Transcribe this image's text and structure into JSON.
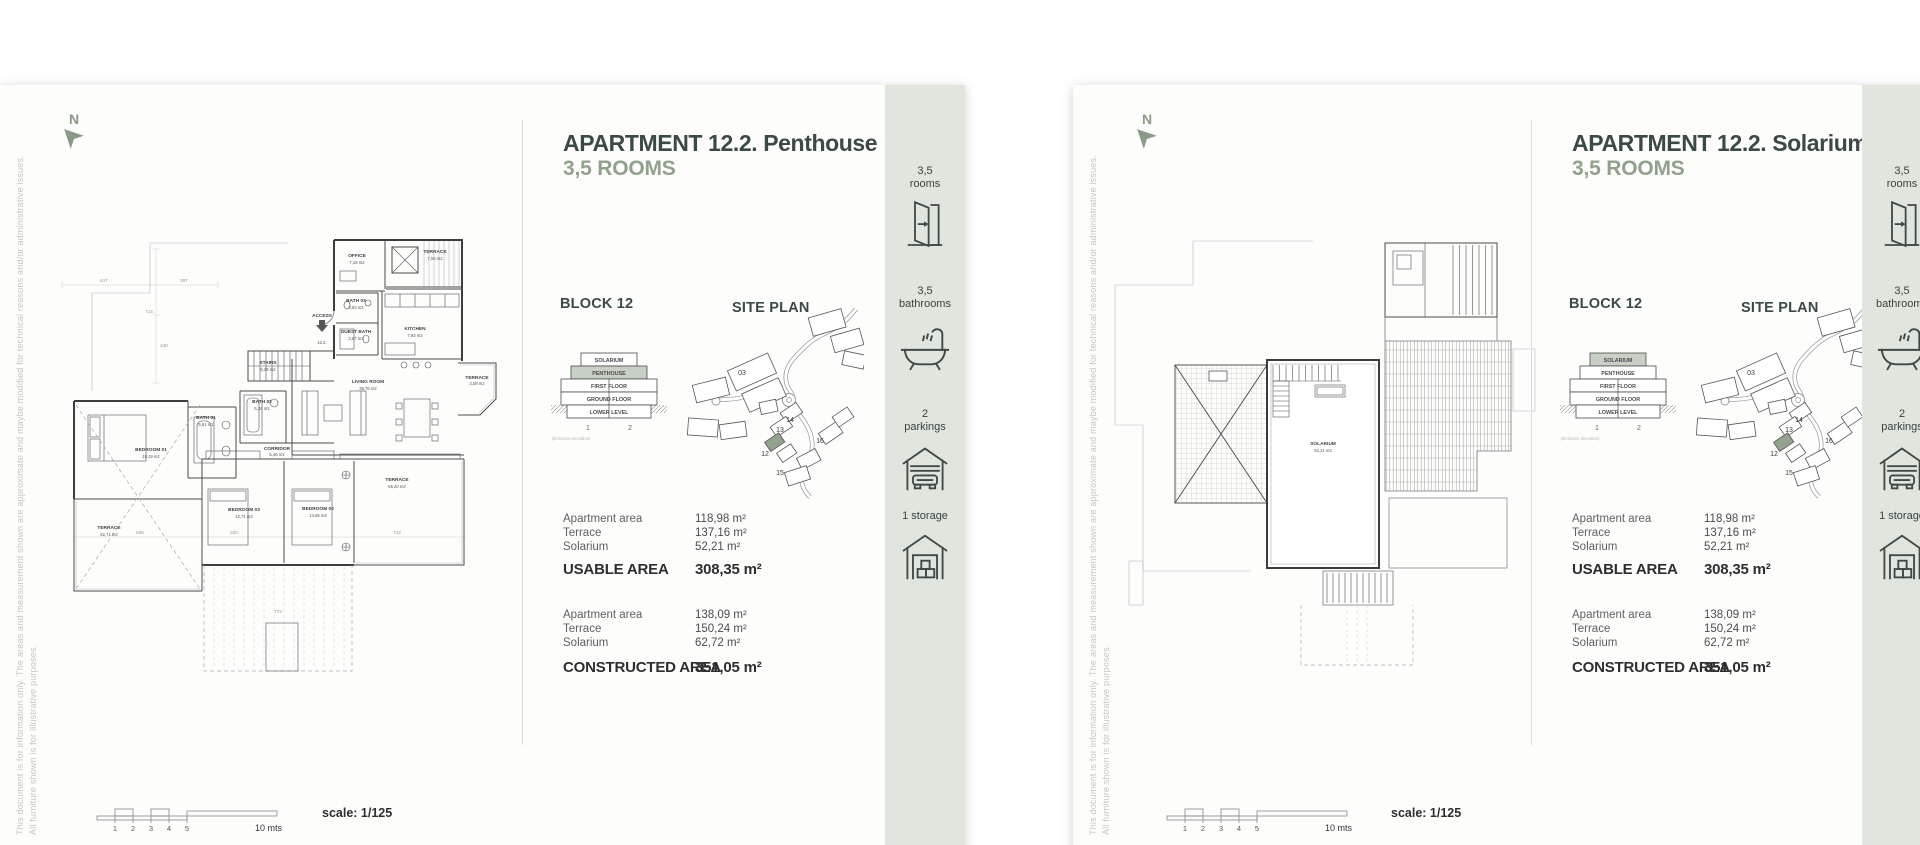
{
  "disclaimer": {
    "line1": "This document is for information only. The areas and measurement shown are approximate and maybe modified for technical reasons and/or administrative issues.",
    "line2": "All furniture shown is for illustrative purposes."
  },
  "compass_label": "N",
  "sidebar": {
    "items": [
      {
        "top": "3,5",
        "bottom": "rooms"
      },
      {
        "top": "3,5",
        "bottom": "bathrooms"
      },
      {
        "top": "2",
        "bottom": "parkings"
      },
      {
        "top": "1 storage",
        "bottom": ""
      }
    ]
  },
  "scalebar": {
    "ticks": [
      "1",
      "2",
      "3",
      "4",
      "5"
    ],
    "end_label": "10 mts",
    "scale_label": "scale: 1/125"
  },
  "stack": {
    "floors": [
      "SOLARIUM",
      "PENTHOUSE",
      "FIRST FLOOR",
      "GROUND FLOOR",
      "LOWER LEVEL"
    ],
    "col1": "1",
    "col2": "2",
    "caption": "(Entrance elevation)"
  },
  "site_map": {
    "b03": "03",
    "b12": "12",
    "b13": "13",
    "b14": "14",
    "b15": "15",
    "b16": "16"
  },
  "pages": [
    {
      "title": "APARTMENT 12.2. Penthouse",
      "subtitle": "3,5 ROOMS",
      "block": "BLOCK 12",
      "site_plan": "SITE PLAN",
      "areas": {
        "rows1": [
          {
            "label": "Apartment area",
            "value": "118,98 m²"
          },
          {
            "label": "Terrace",
            "value": "137,16 m²"
          },
          {
            "label": "Solarium",
            "value": "52,21 m²"
          }
        ],
        "total1_label": "USABLE AREA",
        "total1_value": "308,35 m²",
        "rows2": [
          {
            "label": "Apartment area",
            "value": "138,09 m²"
          },
          {
            "label": "Terrace",
            "value": "150,24 m²"
          },
          {
            "label": "Solarium",
            "value": "62,72 m²"
          }
        ],
        "total2_label": "CONSTRUCTED AREA",
        "total2_value": "351,05 m²"
      }
    },
    {
      "title": "APARTMENT 12.2. Solarium",
      "subtitle": "3,5 ROOMS",
      "block": "BLOCK 12",
      "site_plan": "SITE PLAN",
      "areas": {
        "rows1": [
          {
            "label": "Apartment area",
            "value": "118,98 m²"
          },
          {
            "label": "Terrace",
            "value": "137,16 m²"
          },
          {
            "label": "Solarium",
            "value": "52,21 m²"
          }
        ],
        "total1_label": "USABLE AREA",
        "total1_value": "308,35 m²",
        "rows2": [
          {
            "label": "Apartment area",
            "value": "138,09 m²"
          },
          {
            "label": "Terrace",
            "value": "150,24 m²"
          },
          {
            "label": "Solarium",
            "value": "62,72 m²"
          }
        ],
        "total2_label": "CONSTRUCTED AREA",
        "total2_value": "351,05 m²"
      }
    }
  ],
  "plan_left": {
    "rooms": [
      {
        "name": "OFFICE",
        "area": "7,18 m2"
      },
      {
        "name": "TERRACE",
        "area": "7,06 m2"
      },
      {
        "name": "BATH 03",
        "area": "3,83 m2"
      },
      {
        "name": "KITCHEN",
        "area": "7,93 m2"
      },
      {
        "name": "GUEST BATH",
        "area": "3,67 m2"
      },
      {
        "name": "STAIRS",
        "area": "5,29 m2"
      },
      {
        "name": "LIVING ROOM",
        "area": "36,76 m2"
      },
      {
        "name": "TERRACE",
        "area": "3,59 m2"
      },
      {
        "name": "BATH 02",
        "area": "5,26 m2"
      },
      {
        "name": "BATH 01",
        "area": "5,51 m2"
      },
      {
        "name": "BEDROOM 01",
        "area": "19,19 m2"
      },
      {
        "name": "CORRIDOR",
        "area": "5,45 m2"
      },
      {
        "name": "BEDROOM 03",
        "area": "12,71 m2"
      },
      {
        "name": "BEDROOM 02",
        "area": "14,55 m2"
      },
      {
        "name": "TERRACE",
        "area": "55,20 m2"
      },
      {
        "name": "TERRACE",
        "area": "62,71 m2"
      }
    ],
    "access": "ACCESS",
    "unit": "12.2.",
    "dims": [
      "417",
      "297",
      "714",
      "440",
      "556",
      "320",
      "712",
      "772"
    ]
  },
  "plan_right": {
    "rooms": [
      {
        "name": "SOLARIUM",
        "area": "52,21 m2"
      }
    ]
  }
}
